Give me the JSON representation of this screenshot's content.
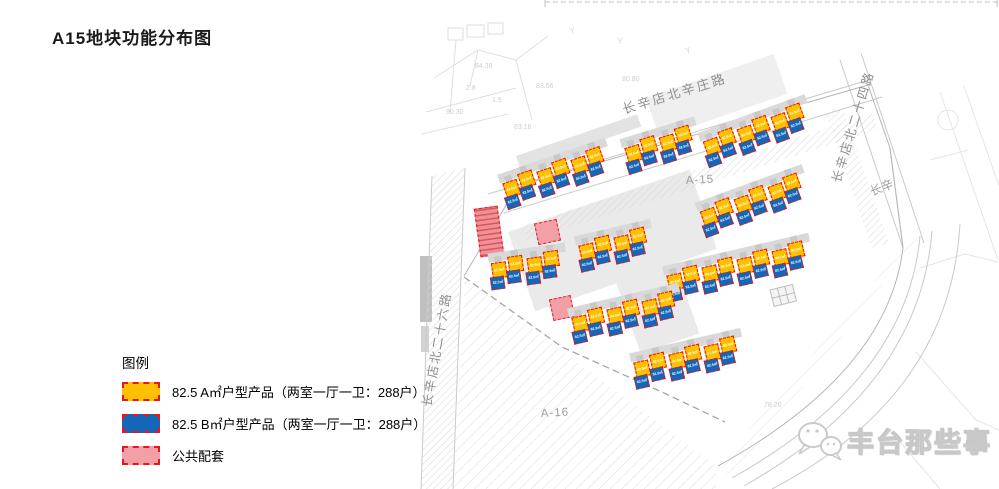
{
  "title": "A15地块功能分布图",
  "legend": {
    "heading": "图例",
    "items": [
      {
        "label": "82.5 A㎡户型产品（两室一厅一卫：288户）",
        "color": "#FFC000",
        "type": "unit-a"
      },
      {
        "label": "82.5 B㎡户型产品（两室一厅一卫：288户）",
        "color": "#1467B8",
        "type": "unit-b"
      },
      {
        "label": "公共配套",
        "color": "#F2A0A6",
        "type": "public"
      }
    ]
  },
  "map": {
    "plot_labels": [
      {
        "text": "A-15"
      },
      {
        "text": "A-16"
      }
    ],
    "road_labels": [
      {
        "text": "长辛店北辛庄路"
      },
      {
        "text": "长辛店北二十四路"
      },
      {
        "text": "长辛店北二十六路"
      },
      {
        "text": "长辛"
      }
    ],
    "survey_marks": [
      {
        "text": "90.30"
      },
      {
        "text": "84.39"
      },
      {
        "text": "2.8"
      },
      {
        "text": "1.5"
      },
      {
        "text": "83.56"
      },
      {
        "text": "83.16"
      },
      {
        "text": "80.80"
      },
      {
        "text": "78.20"
      }
    ],
    "unit_block_label": "82.5㎡",
    "colors": {
      "unit_a": "#FFC000",
      "unit_b": "#1467B8",
      "outline": "#EE1111"
    },
    "clusters": [
      {
        "x": 293,
        "y": 170,
        "pairs": 3,
        "rot": -20
      },
      {
        "x": 213,
        "y": 177,
        "pairs": 2,
        "rot": -17
      },
      {
        "x": 92,
        "y": 212,
        "pairs": 3,
        "rot": -19
      },
      {
        "x": 290,
        "y": 240,
        "pairs": 3,
        "rot": -20
      },
      {
        "x": 75,
        "y": 293,
        "pairs": 2,
        "rot": -8
      },
      {
        "x": 165,
        "y": 275,
        "pairs": 2,
        "rot": -13
      },
      {
        "x": 253,
        "y": 305,
        "pairs": 4,
        "rot": -13
      },
      {
        "x": 158,
        "y": 347,
        "pairs": 3,
        "rot": -13
      },
      {
        "x": 220,
        "y": 392,
        "pairs": 3,
        "rot": -13
      }
    ],
    "public_shapes": [
      {
        "x": 57,
        "y": 207,
        "w": 24,
        "h": 49,
        "rot": -8,
        "style": "striped"
      },
      {
        "x": 116,
        "y": 221,
        "w": 23,
        "h": 22,
        "rot": -12,
        "style": "plain"
      },
      {
        "x": 131,
        "y": 297,
        "w": 22,
        "h": 22,
        "rot": -12,
        "style": "plain"
      }
    ]
  },
  "watermark": {
    "text": "丰台那些事"
  }
}
